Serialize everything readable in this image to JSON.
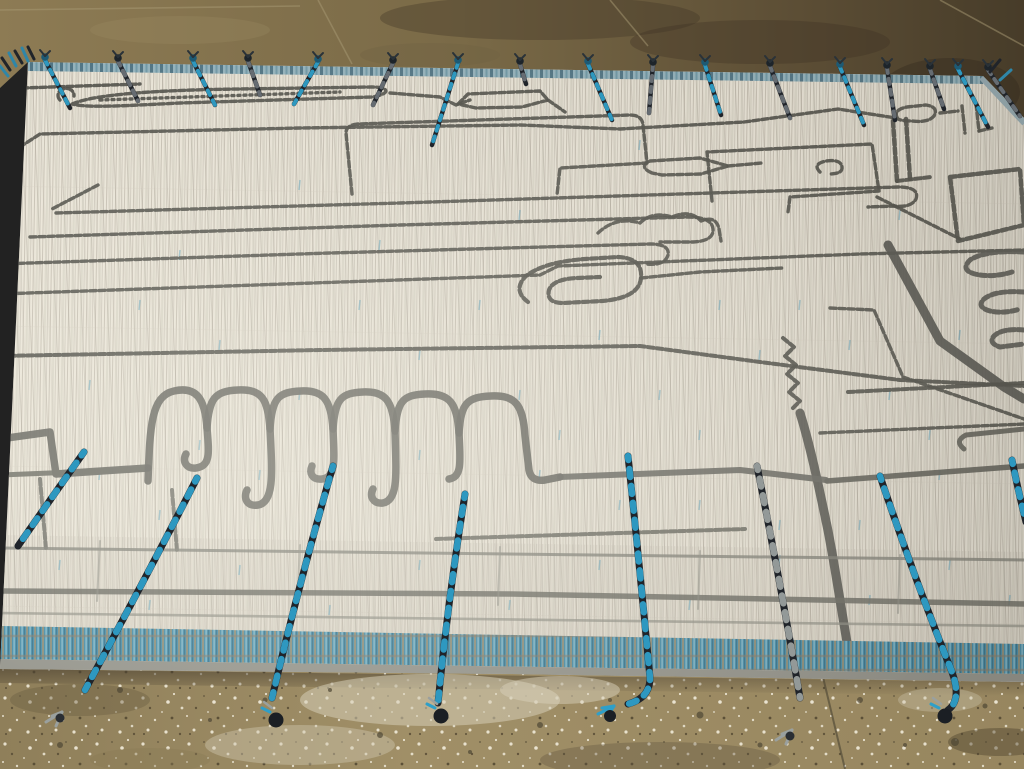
{
  "scene": {
    "type": "photograph",
    "subject": "modern Moroccan-style cream wool area rug with abstract charcoal linework, teal flat-woven end band and long blue-and-black braided tassels, lying on a stained tan concrete floor"
  },
  "palette": {
    "floor_top_left": "#8d7b54",
    "floor_top_right": "#473c29",
    "floor_bottom": "#9d8c65",
    "rug_field": "#eae5d8",
    "weave_streak": "#b6b0a2",
    "charcoal_line": "#4e4e48",
    "thick_gray_line": "#62625b",
    "teal_band": "#3e87a4",
    "top_band_blue": "#93b2bc",
    "selvedge_gray": "#8e8e86",
    "tassel_blue": "#2f9fc8",
    "tassel_black": "#20242a",
    "tassel_gray": "#9aa09e",
    "speckle": "#efe9d8"
  },
  "rug": {
    "clip": "28,62 983,76 1024,118 1024,682 512,674 0,669",
    "top_band": "28,62 983,76 983,84 28,71",
    "plaid_zone": "0,535 1024,552 1024,644 0,626",
    "teal_band_poly": "0,626 1024,644 1024,674 0,659",
    "selvedge_poly": "0,659 1024,674 1024,682 0,669",
    "corner_band_d": "M983,76 L1026,122",
    "left_edge_band_d": "M28,62 L0,90"
  },
  "floor": {
    "top_poly": "0,0 1024,0 1024,120 983,76 28,62 0,88",
    "bottom_poly": "0,669 512,674 1024,682 1024,769 0,769",
    "shadow_poly": "0,669 1024,682 1024,696 0,683",
    "seams": [
      "M318,0 L352,64",
      "M610,0 L648,46",
      "M940,0 L1024,46",
      "M0,10 L300,6"
    ],
    "stains_top": [
      [
        540,
        18,
        160,
        22,
        "#3e3424",
        0.35
      ],
      [
        760,
        42,
        130,
        22,
        "#3a3022",
        0.32
      ],
      [
        180,
        30,
        90,
        14,
        "#9a8a62",
        0.3
      ],
      [
        950,
        92,
        70,
        34,
        "#352c1e",
        0.42
      ],
      [
        430,
        55,
        70,
        12,
        "#6d5f42",
        0.3
      ]
    ],
    "patches": [
      [
        430,
        700,
        130,
        26,
        "#d6cdb6",
        0.55
      ],
      [
        300,
        745,
        95,
        20,
        "#cfc6ae",
        0.45
      ],
      [
        560,
        690,
        60,
        14,
        "#d8d0ba",
        0.5
      ],
      [
        940,
        700,
        42,
        12,
        "#c9c0a8",
        0.4
      ],
      [
        660,
        760,
        120,
        18,
        "#5f5340",
        0.35
      ],
      [
        80,
        700,
        70,
        16,
        "#6a5c42",
        0.4
      ],
      [
        1000,
        742,
        52,
        14,
        "#4f452f",
        0.45
      ],
      [
        150,
        760,
        60,
        12,
        "#8a7a55",
        0.4
      ]
    ],
    "pebbles": [
      [
        120,
        690,
        3
      ],
      [
        210,
        720,
        2
      ],
      [
        265,
        700,
        2.5
      ],
      [
        380,
        735,
        3
      ],
      [
        470,
        752,
        2
      ],
      [
        540,
        725,
        3
      ],
      [
        610,
        700,
        2
      ],
      [
        700,
        715,
        3.5
      ],
      [
        760,
        745,
        2.5
      ],
      [
        860,
        700,
        3
      ],
      [
        905,
        745,
        2
      ],
      [
        955,
        742,
        4
      ],
      [
        985,
        706,
        2.5
      ],
      [
        60,
        745,
        3
      ],
      [
        330,
        690,
        2
      ]
    ],
    "crack": "M822,673 L845,769"
  },
  "motifs": [
    {
      "d": "M22,88 L140,84"
    },
    {
      "d": "M20,88 L13,150"
    },
    {
      "d": "M12,152 L40,134 L300,128 L520,125 L620,129 L744,122"
    },
    {
      "d": "M744,122 L838,109 L896,118"
    },
    {
      "d": "M898,119 Q892,110 907,107 L926,105 Q939,107 934,116 Q928,123 912,121 Q902,121 898,119 Z"
    },
    {
      "d": "M940,113 L958,111"
    },
    {
      "d": "M962,106 L965,133"
    },
    {
      "d": "M976,104 L979,131"
    },
    {
      "d": "M979,131 L992,128"
    },
    {
      "d": "M72,104 C95,94 160,90 240,89 L372,87 C390,87 391,94 372,97 L180,103 C120,106 88,108 72,104 Z"
    },
    {
      "d": "M100,100 L340,92",
      "da": "2 4"
    },
    {
      "d": "M60,100 a8,7 0 1 1 14,-4"
    },
    {
      "d": "M390,93 L440,97 L456,105 L470,100"
    },
    {
      "d": "M458,104 L468,94 L540,91 L548,100 L522,107 L476,108 Z"
    },
    {
      "d": "M548,100 L565,112"
    },
    {
      "d": "M352,194 L346,133 Q346,125 358,124 L630,115 Q642,115 643,125 L647,163 L560,168 L557,195"
    },
    {
      "d": "M98,185 L52,209"
    },
    {
      "d": "M652,173 Q638,167 650,161 L700,158 L728,166 L701,174 L662,175 Z"
    },
    {
      "d": "M728,166 L762,163"
    },
    {
      "d": "M712,201 L707,152 L872,144 L879,191 L790,197 L788,212"
    },
    {
      "d": "M820,172 Q812,164 826,161 Q841,159 842,167 Q843,174 829,174"
    },
    {
      "d": "M877,197 L960,239"
    },
    {
      "d": "M950,177 L1020,169 L1024,225 L958,241 Z",
      "w": 4.5
    },
    {
      "d": "M598,233 Q616,216 640,223 Q652,211 672,217 Q690,209 701,221 Q716,215 719,229 L721,241"
    },
    {
      "d": "M56,213 L400,203 L898,187 Q920,187 916,199 Q911,208 894,206 L868,207"
    },
    {
      "d": "M30,237 L400,225 L688,217 Q712,217 713,229 Q714,241 693,242 L660,242"
    },
    {
      "d": "M0,264 L330,253 L650,244 Q670,244 668,255 Q665,266 646,264"
    },
    {
      "d": "M0,294 L540,275 L558,266 L860,254 L1024,250"
    },
    {
      "d": "M0,356 L320,350 L640,346 L760,362 L900,380 L1024,386",
      "w": 4
    },
    {
      "d": "M528,302 Q512,290 526,276 Q544,262 585,259 L618,257 Q643,258 641,278 Q639,298 602,301 L563,303 Q546,303 549,290 Q553,279 577,278 L600,277",
      "w": 4.2
    },
    {
      "d": "M641,278 L700,272 L782,268"
    },
    {
      "d": "M783,338 l11,9 l-9,9 l11,9 l-9,9 l11,9 l-9,9 l11,9 l-8,8",
      "w": 4
    },
    {
      "d": "M893,121 L897,181",
      "w": 4.5
    },
    {
      "d": "M906,119 L910,179",
      "w": 4.5
    },
    {
      "d": "M897,181 L931,177",
      "w": 4
    },
    {
      "d": "M1024,252 Q985,250 970,260 Q960,270 975,274 Q992,278 1012,272",
      "w": 5,
      "c": "#575751"
    },
    {
      "d": "M1024,292 Q995,290 984,299 Q976,307 990,311 Q1004,314 1020,309",
      "w": 5,
      "c": "#575751"
    },
    {
      "d": "M1024,330 Q1002,328 994,336 Q988,343 1000,347 L1024,344",
      "w": 5,
      "c": "#575751"
    },
    {
      "d": "M888,245 L940,341 L1004,387 L1024,399",
      "w": 9,
      "c": "#53534d",
      "da": ""
    },
    {
      "d": "M830,308 L874,310 L903,377 L1024,419"
    },
    {
      "d": "M820,433 L1024,424"
    },
    {
      "d": "M848,392 L1024,383",
      "w": 4
    },
    {
      "d": "M800,413 C810,445 818,483 826,521 C833,553 840,602 848,648",
      "w": 9,
      "c": "#54544e",
      "da": ""
    },
    {
      "d": "M827,481 L1024,466",
      "w": 5.5,
      "c": "#5d5d56",
      "da": ""
    },
    {
      "d": "M0,439 L50,432 L56,474 L148,468",
      "w": 7.5,
      "c": "#62625b",
      "da": ""
    },
    {
      "d": "M0,475 L148,469",
      "w": 5,
      "c": "#6a6a62",
      "da": ""
    },
    {
      "d": "M148,481 C150,426 151,396 174,391 C196,386 205,398 207,428 C209,452 211,466 196,468 C186,469 182,461 186,454",
      "w": 7.5,
      "c": "#62625b",
      "da": ""
    },
    {
      "d": "M207,428 C209,398 215,391 238,390 C262,389 268,399 270,429 C272,470 275,502 258,505 C247,507 243,498 247,490",
      "w": 7.5,
      "c": "#62625b",
      "da": ""
    },
    {
      "d": "M270,429 C272,398 278,392 301,391 C323,390 331,399 333,429 C334,458 337,477 322,479 C312,480 309,473 312,466",
      "w": 7.5,
      "c": "#62625b",
      "da": ""
    },
    {
      "d": "M333,429 C335,399 341,393 363,392 C385,391 393,400 395,431 C396,472 399,500 383,503 C373,504 369,496 373,489",
      "w": 7.5,
      "c": "#62625b",
      "da": ""
    },
    {
      "d": "M395,431 C397,401 403,395 425,394 C449,393 457,402 459,433 C460,459 463,477 449,479",
      "w": 7.5,
      "c": "#62625b",
      "da": ""
    },
    {
      "d": "M459,433 C461,403 467,397 491,396 C515,395 523,404 525,436 L529,470 Q531,482 545,480 L560,477",
      "w": 7.5,
      "c": "#62625b",
      "da": ""
    },
    {
      "d": "M560,477 L740,470 L826,480",
      "w": 6,
      "c": "#66665f",
      "da": ""
    },
    {
      "d": "M40,479 L46,549",
      "w": 4,
      "c": "#6e6e66"
    },
    {
      "d": "M172,490 L177,551",
      "w": 4,
      "c": "#6e6e66"
    },
    {
      "d": "M436,539 L745,529",
      "w": 4,
      "c": "#6a6a62"
    },
    {
      "d": "M964,449 Q954,441 966,435 L1024,429",
      "w": 5,
      "c": "#5d5d56",
      "da": ""
    },
    {
      "d": "M0,548 L1024,560",
      "w": 3,
      "c": "#7d7d74",
      "o": 0.8,
      "da": ""
    },
    {
      "d": "M0,591 L512,594 L1024,604",
      "w": 5.5,
      "c": "#67675f",
      "o": 0.85,
      "da": ""
    },
    {
      "d": "M0,613 L1024,626",
      "w": 2.6,
      "c": "#8c8c82",
      "o": 0.7,
      "da": ""
    },
    {
      "d": "M100,541 L97,601",
      "w": 2,
      "c": "#8d8d83",
      "o": 0.55,
      "da": ""
    },
    {
      "d": "M300,545 L297,607",
      "w": 2,
      "c": "#8d8d83",
      "o": 0.55,
      "da": ""
    },
    {
      "d": "M500,547 L498,605",
      "w": 2,
      "c": "#8d8d83",
      "o": 0.55,
      "da": ""
    },
    {
      "d": "M700,551 L698,609",
      "w": 2,
      "c": "#8d8d83",
      "o": 0.55,
      "da": ""
    },
    {
      "d": "M900,555 L898,613",
      "w": 2,
      "c": "#8d8d83",
      "o": 0.55,
      "da": ""
    }
  ],
  "flecks": [
    [
      140,
      300
    ],
    [
      220,
      340
    ],
    [
      90,
      380
    ],
    [
      300,
      390
    ],
    [
      360,
      300
    ],
    [
      420,
      350
    ],
    [
      480,
      300
    ],
    [
      520,
      390
    ],
    [
      560,
      430
    ],
    [
      600,
      330
    ],
    [
      660,
      390
    ],
    [
      700,
      430
    ],
    [
      720,
      300
    ],
    [
      760,
      350
    ],
    [
      800,
      300
    ],
    [
      850,
      340
    ],
    [
      890,
      390
    ],
    [
      930,
      430
    ],
    [
      960,
      330
    ],
    [
      200,
      440
    ],
    [
      260,
      470
    ],
    [
      420,
      450
    ],
    [
      540,
      470
    ],
    [
      620,
      500
    ],
    [
      700,
      500
    ],
    [
      780,
      520
    ],
    [
      860,
      520
    ],
    [
      940,
      470
    ],
    [
      100,
      470
    ],
    [
      160,
      510
    ],
    [
      60,
      560
    ],
    [
      150,
      600
    ],
    [
      240,
      565
    ],
    [
      330,
      605
    ],
    [
      420,
      560
    ],
    [
      510,
      600
    ],
    [
      600,
      560
    ],
    [
      690,
      600
    ],
    [
      780,
      555
    ],
    [
      870,
      595
    ],
    [
      950,
      560
    ],
    [
      1010,
      595
    ],
    [
      380,
      240
    ],
    [
      300,
      180
    ],
    [
      520,
      210
    ],
    [
      640,
      140
    ],
    [
      180,
      250
    ],
    [
      900,
      210
    ]
  ],
  "tassels_bottom": [
    {
      "d": "M84,452 Q50,500 18,546",
      "tip": {
        "t": "none",
        "x": 18,
        "y": 546
      }
    },
    {
      "d": "M197,478 Q150,570 85,690",
      "tip": {
        "t": "grayfray",
        "x": 62,
        "y": 712
      }
    },
    {
      "d": "M333,466 Q300,580 272,698",
      "tip": {
        "t": "knob",
        "x": 276,
        "y": 720
      }
    },
    {
      "d": "M465,494 Q448,600 438,703",
      "tip": {
        "t": "knob",
        "x": 441,
        "y": 716
      }
    },
    {
      "d": "M628,456 Q640,570 650,678 Q650,698 628,704",
      "tip": {
        "t": "bluefray",
        "x": 614,
        "y": 706
      }
    },
    {
      "d": "M757,466 Q780,580 800,698",
      "accent": "#9aa09e",
      "tip": {
        "t": "grayfray",
        "x": 792,
        "y": 730
      }
    },
    {
      "d": "M880,476 Q915,580 952,672 Q962,700 948,710",
      "tip": {
        "t": "knob",
        "x": 945,
        "y": 716
      }
    },
    {
      "d": "M1012,460 Q1018,490 1026,522",
      "tip": {
        "t": "none",
        "x": 1026,
        "y": 522
      }
    }
  ],
  "tassels_top": [
    {
      "x": 45,
      "y": 60,
      "dx": 25,
      "dy": 48,
      "c": "b"
    },
    {
      "x": 118,
      "y": 61,
      "dx": 20,
      "dy": 40,
      "c": "k"
    },
    {
      "x": 193,
      "y": 61,
      "dx": 22,
      "dy": 44,
      "c": "b"
    },
    {
      "x": 248,
      "y": 61,
      "dx": 12,
      "dy": 34,
      "c": "k"
    },
    {
      "x": 318,
      "y": 62,
      "dx": -24,
      "dy": 42,
      "c": "b"
    },
    {
      "x": 393,
      "y": 63,
      "dx": -20,
      "dy": 42,
      "c": "k"
    },
    {
      "x": 458,
      "y": 63,
      "dx": -26,
      "dy": 82,
      "c": "b"
    },
    {
      "x": 520,
      "y": 64,
      "dx": 6,
      "dy": 20,
      "c": "k"
    },
    {
      "x": 588,
      "y": 64,
      "dx": 24,
      "dy": 56,
      "c": "b"
    },
    {
      "x": 653,
      "y": 65,
      "dx": -4,
      "dy": 48,
      "c": "k"
    },
    {
      "x": 705,
      "y": 65,
      "dx": 16,
      "dy": 50,
      "c": "b"
    },
    {
      "x": 770,
      "y": 66,
      "dx": 20,
      "dy": 52,
      "c": "k"
    },
    {
      "x": 840,
      "y": 67,
      "dx": 24,
      "dy": 58,
      "c": "b"
    },
    {
      "x": 887,
      "y": 68,
      "dx": 8,
      "dy": 52,
      "c": "k"
    },
    {
      "x": 930,
      "y": 69,
      "dx": 14,
      "dy": 40,
      "c": "k"
    },
    {
      "x": 958,
      "y": 69,
      "dx": 30,
      "dy": 58,
      "c": "b"
    },
    {
      "x": 988,
      "y": 70,
      "dx": 32,
      "dy": 46,
      "c": "k"
    }
  ],
  "corner_fringe": [
    {
      "x": 10,
      "y": 70,
      "dx": -8,
      "dy": -12,
      "c": "k"
    },
    {
      "x": 16,
      "y": 66,
      "dx": -7,
      "dy": -13,
      "c": "b"
    },
    {
      "x": 22,
      "y": 63,
      "dx": -7,
      "dy": -12,
      "c": "k"
    },
    {
      "x": 28,
      "y": 61,
      "dx": -6,
      "dy": -13,
      "c": "b"
    },
    {
      "x": 34,
      "y": 59,
      "dx": -6,
      "dy": -12,
      "c": "k"
    },
    {
      "x": 8,
      "y": 76,
      "dx": -8,
      "dy": -10,
      "c": "b"
    },
    {
      "x": 990,
      "y": 72,
      "dx": 10,
      "dy": -12,
      "c": "k"
    },
    {
      "x": 1000,
      "y": 80,
      "dx": 11,
      "dy": -10,
      "c": "b"
    }
  ]
}
